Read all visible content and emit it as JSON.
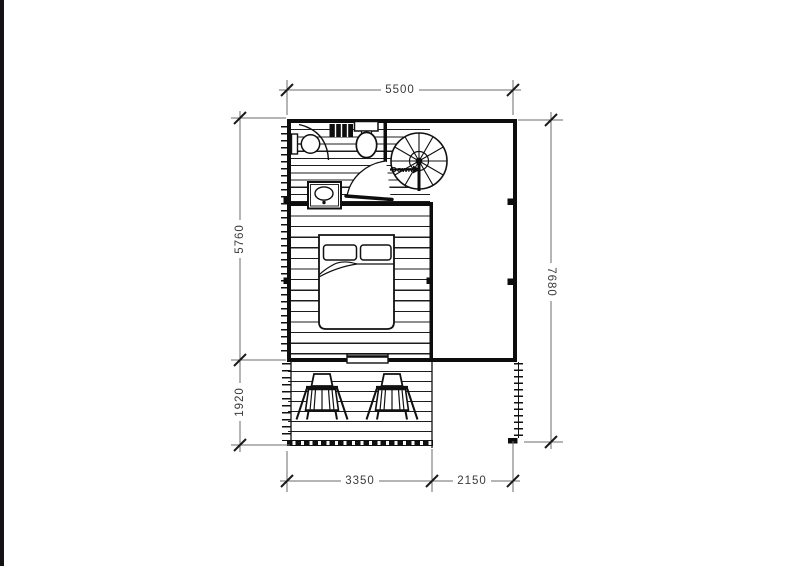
{
  "plan": {
    "stair_label": "Down",
    "dimensions": {
      "overall_width": "5500",
      "upper_height": "5760",
      "deck_height": "1920",
      "overall_height": "7680",
      "deck_width": "3350",
      "right_offset": "2150"
    },
    "colors": {
      "line": "#111111",
      "dimension_line": "#6b6b6b",
      "dimension_text": "#3a3a3a",
      "background": "#ffffff",
      "edge_bar": "#151015"
    }
  }
}
